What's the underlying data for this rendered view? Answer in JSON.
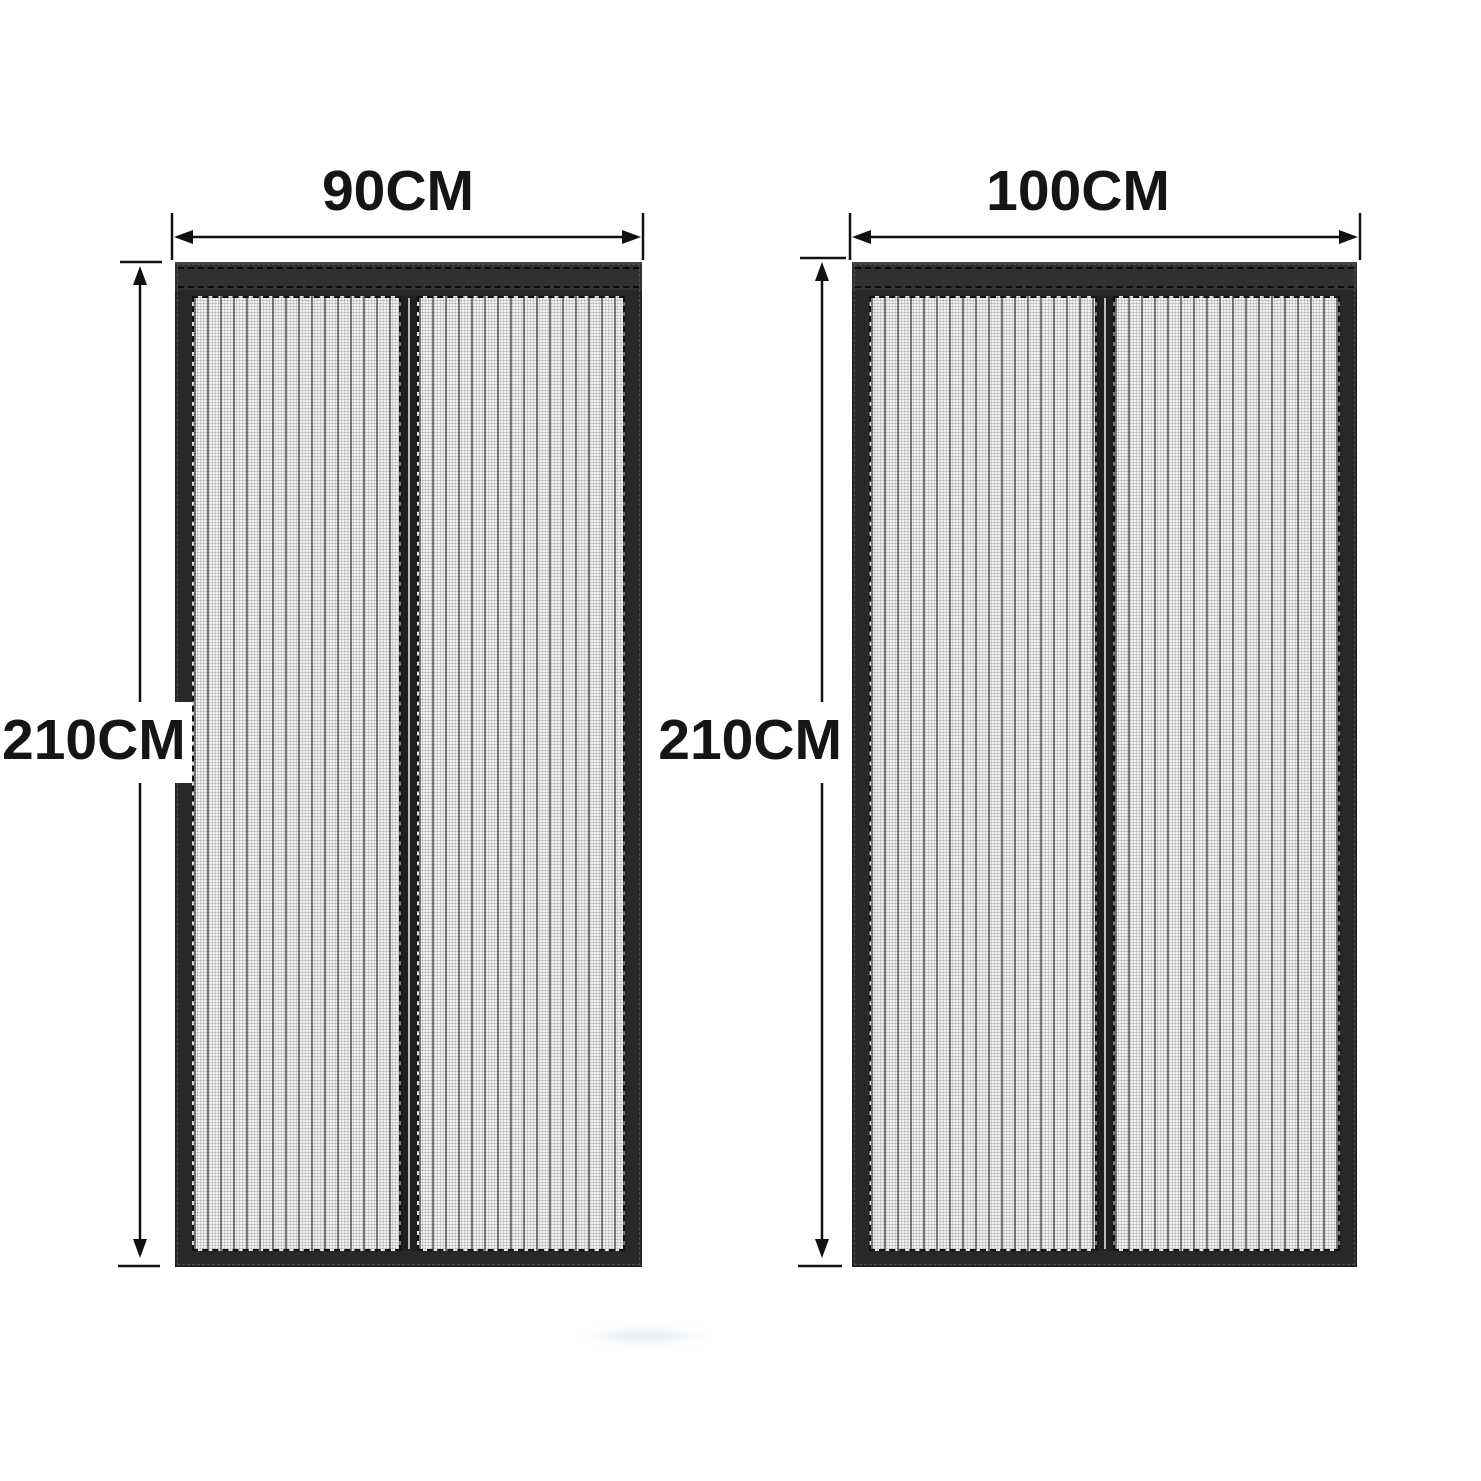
{
  "figure": {
    "title_visible": false,
    "doors": [
      {
        "name": "magnetic-screen-door-90cm",
        "width_label": "90CM",
        "height_label": "210CM"
      },
      {
        "name": "magnetic-screen-door-100cm",
        "width_label": "100CM",
        "height_label": "210CM"
      }
    ],
    "colors": {
      "background": "#ffffff",
      "door_frame": "#282828",
      "door_top_rail": "#313131",
      "mesh": "#ececec",
      "mesh_pleat_line": "#5a5a5a",
      "center_seam_light": "#d7d7d7",
      "dimension_line": "#111111",
      "label_text": "#151515"
    }
  }
}
